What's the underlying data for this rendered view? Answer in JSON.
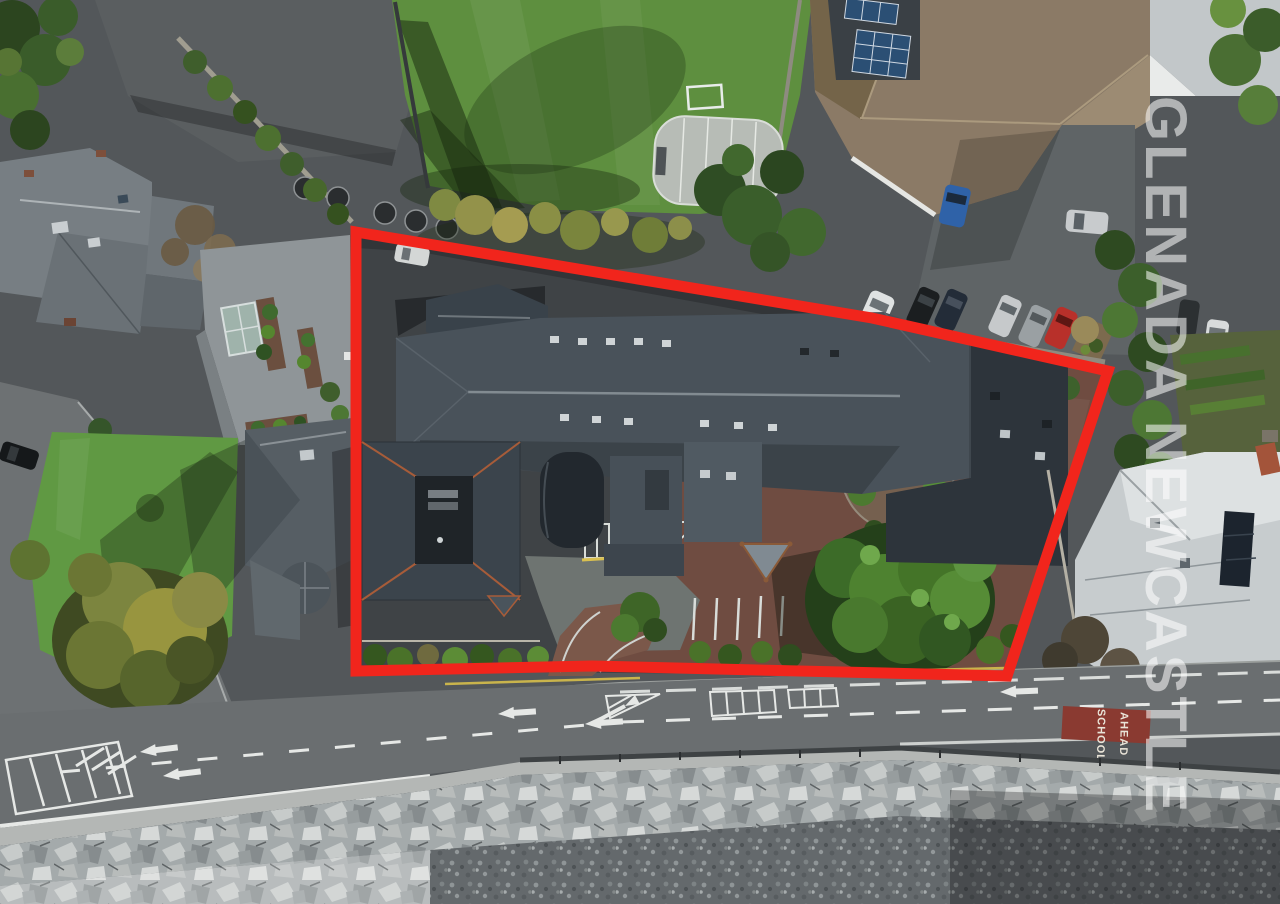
{
  "watermark": {
    "text": "GLENADA NEWCASTLE",
    "color": "#ffffff",
    "opacity": "0.55"
  },
  "boundary": {
    "points": "356,232 872,318 1108,371 1007,676 592,666 356,671",
    "color": "#f1251c",
    "stroke_width": "11"
  },
  "road_text": {
    "school": "SCHOOL",
    "ahead": "AHEAD",
    "patch_color": "#8a3a31",
    "text_color": "#e9e4d8"
  },
  "palette": {
    "field_green": "#5e8f3f",
    "lawn_green": "#609943",
    "site_tarmac": "#6f4c41",
    "slate_roof": "#49525a",
    "dark_slate_roof": "#2d343b",
    "tan_roof": "#8b7a66",
    "road_gray": "#6a6e70",
    "rock_light": "#a8adad",
    "pebble_dark": "#64696c"
  }
}
